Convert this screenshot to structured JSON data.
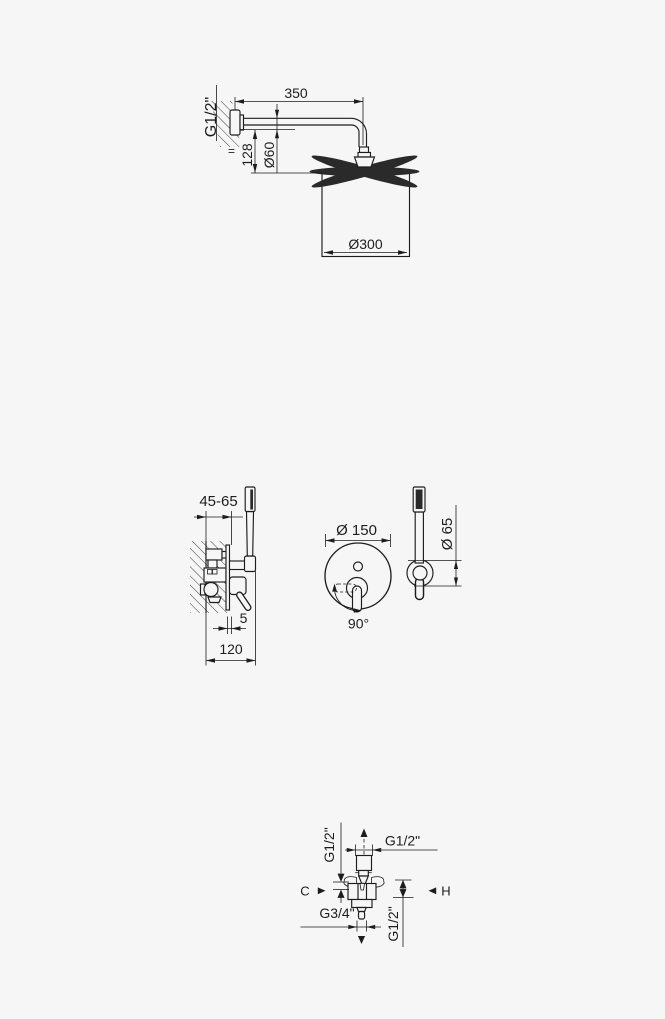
{
  "colors": {
    "background": "#f6f6f6",
    "ink": "#1d1d1d"
  },
  "drawings": {
    "overhead_shower": {
      "labels": {
        "wall_thread": "G1/2\"",
        "arm_length": "350",
        "equal_mark": "=",
        "drop_height": "128",
        "escutcheon_diameter": "Ø60",
        "head_diameter": "Ø300"
      }
    },
    "mixer": {
      "labels": {
        "installation_depth": "45-65",
        "plate_thickness": "5",
        "projection": "120",
        "plate_diameter": "Ø 150",
        "lever_swing": "90°",
        "holder_diameter": "Ø 65"
      }
    },
    "valve": {
      "labels": {
        "left_thread": "G1/2\"",
        "top_thread": "G1/2\"",
        "cold_marker": "C",
        "hot_marker": "H",
        "outlet_thread": "G3/4\"",
        "right_thread": "G1/2\""
      }
    }
  }
}
